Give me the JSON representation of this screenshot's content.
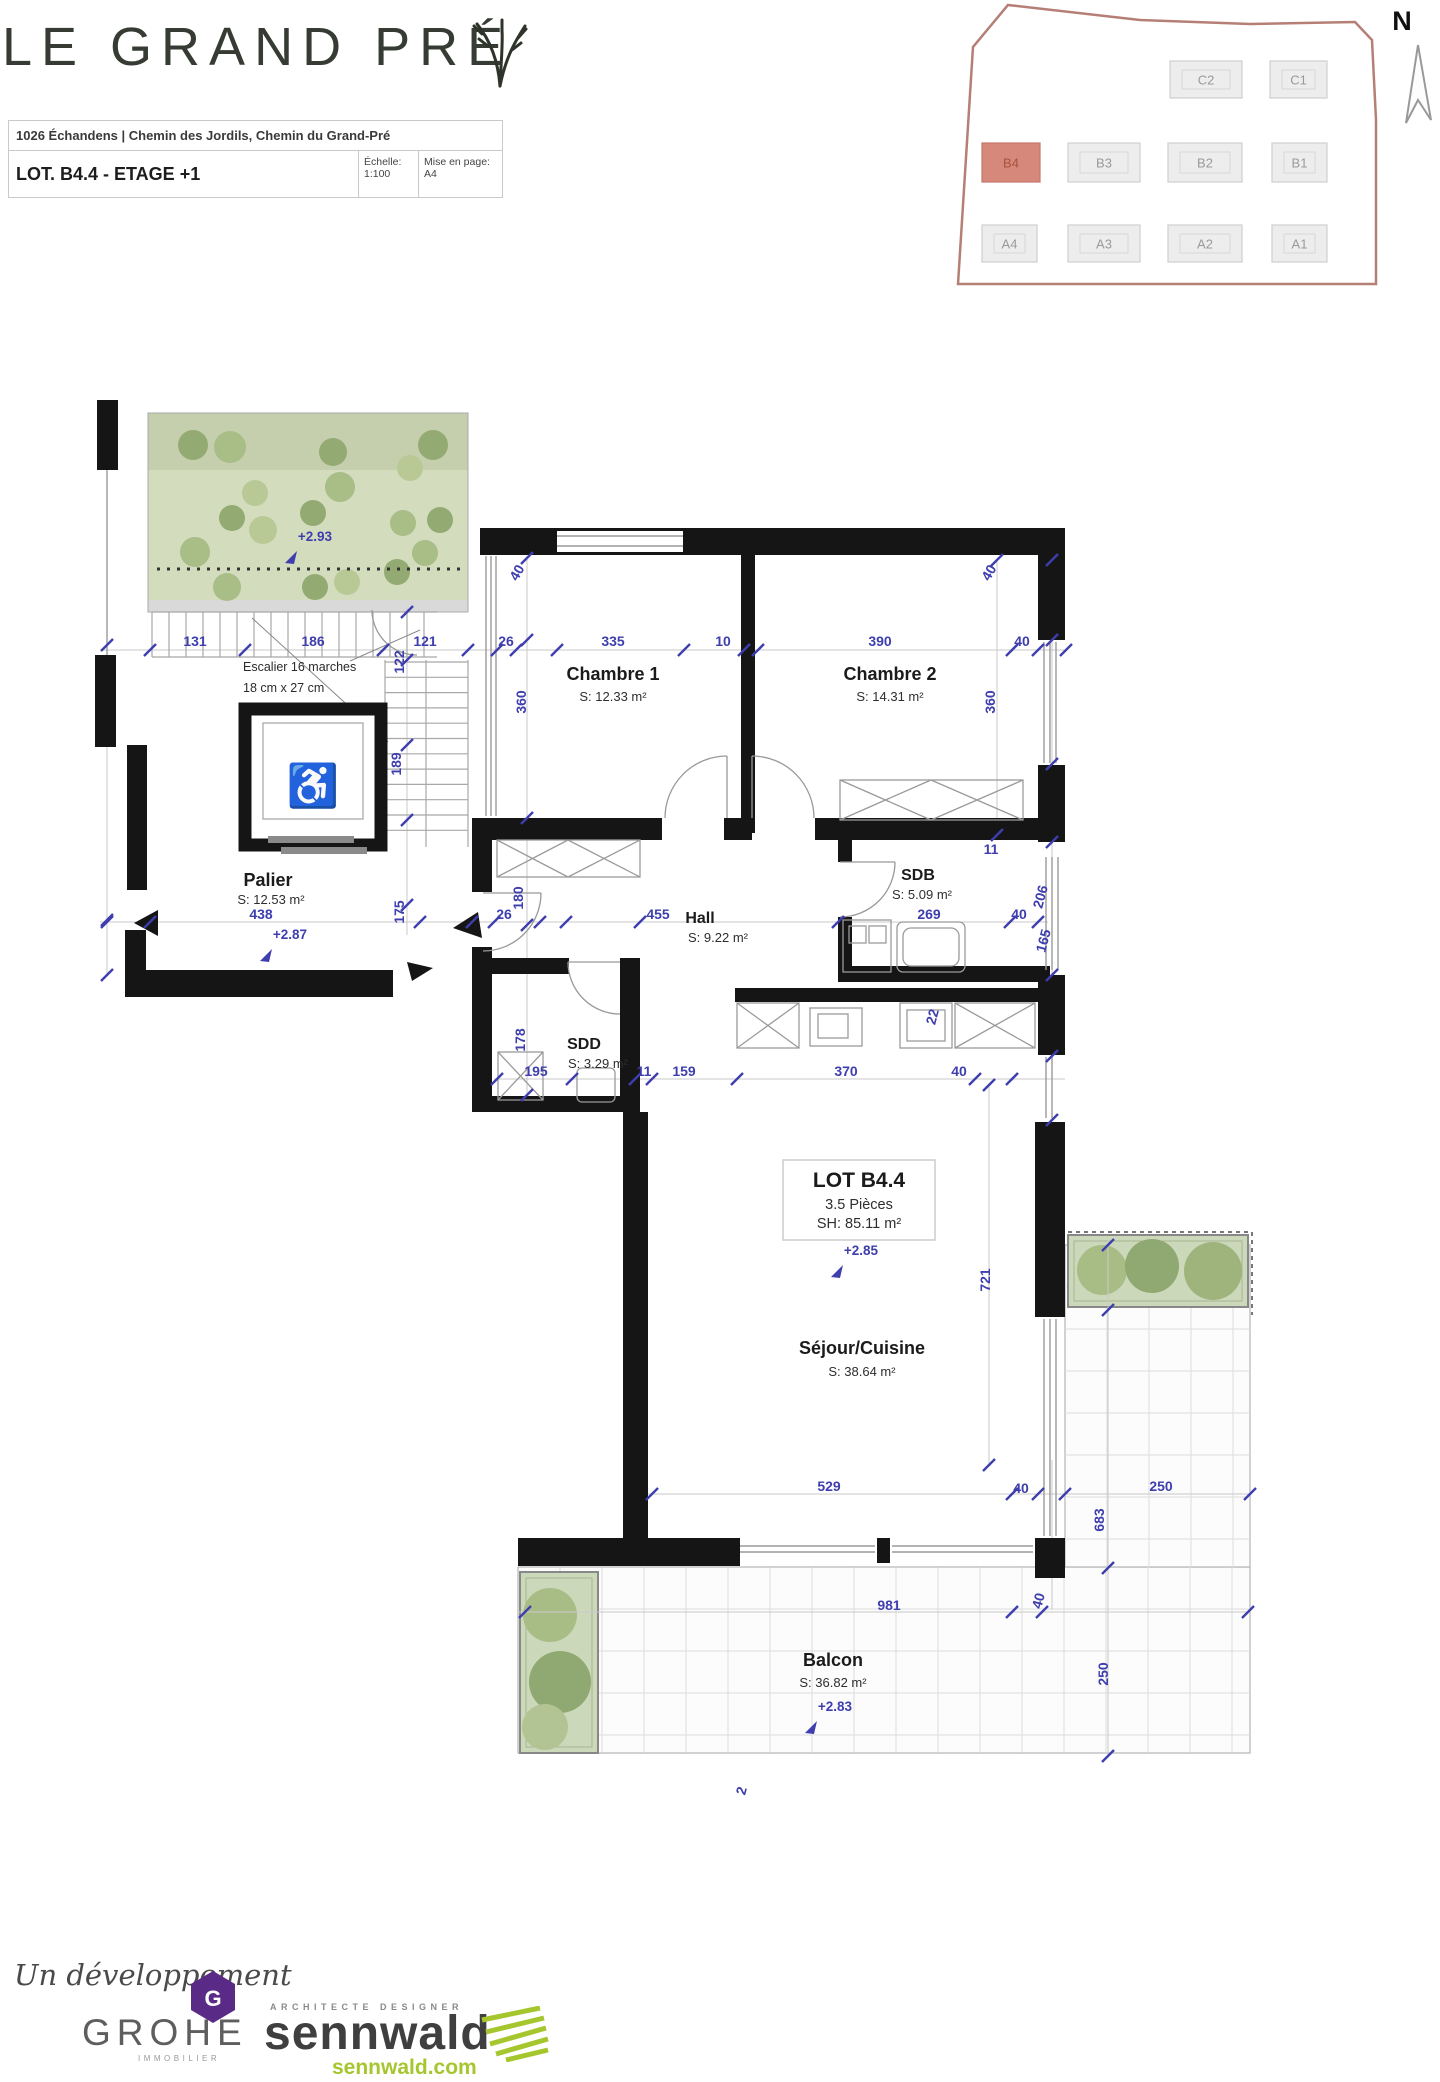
{
  "header": {
    "title": "LE GRAND PRÉ",
    "address": "1026 Échandens | Chemin des Jordils, Chemin du Grand-Pré",
    "lot_title": "LOT. B4.4 - ETAGE +1",
    "scale_label": "Échelle:",
    "scale_value": "1:100",
    "layout_label": "Mise en page:",
    "layout_value": "A4"
  },
  "site_map": {
    "north_label": "N",
    "lots": [
      {
        "id": "C2",
        "x": 1170,
        "y": 61,
        "w": 72,
        "h": 37,
        "hl": false
      },
      {
        "id": "C1",
        "x": 1270,
        "y": 61,
        "w": 57,
        "h": 37,
        "hl": false
      },
      {
        "id": "B4",
        "x": 982,
        "y": 143,
        "w": 58,
        "h": 39,
        "hl": true
      },
      {
        "id": "B3",
        "x": 1068,
        "y": 143,
        "w": 72,
        "h": 39,
        "hl": false
      },
      {
        "id": "B2",
        "x": 1168,
        "y": 143,
        "w": 74,
        "h": 39,
        "hl": false
      },
      {
        "id": "B1",
        "x": 1272,
        "y": 143,
        "w": 55,
        "h": 39,
        "hl": false
      },
      {
        "id": "A4",
        "x": 982,
        "y": 225,
        "w": 55,
        "h": 37,
        "hl": false
      },
      {
        "id": "A3",
        "x": 1068,
        "y": 225,
        "w": 72,
        "h": 37,
        "hl": false
      },
      {
        "id": "A2",
        "x": 1168,
        "y": 225,
        "w": 74,
        "h": 37,
        "hl": false
      },
      {
        "id": "A1",
        "x": 1272,
        "y": 225,
        "w": 55,
        "h": 37,
        "hl": false
      }
    ]
  },
  "plan": {
    "lot_box": {
      "line1": "LOT B4.4",
      "line2": "3.5 Pièces",
      "line3": "SH: 85.11 m²"
    },
    "stair_note_1": "Escalier 16 marches",
    "stair_note_2": "18 cm x 27 cm",
    "rooms": [
      {
        "name": "Chambre 1",
        "area": "S: 12.33 m²",
        "x": 613,
        "y": 680,
        "ax": 613,
        "ay": 701,
        "fs": 18
      },
      {
        "name": "Chambre 2",
        "area": "S: 14.31 m²",
        "x": 890,
        "y": 680,
        "ax": 890,
        "ay": 701,
        "fs": 18
      },
      {
        "name": "SDB",
        "area": "S: 5.09 m²",
        "x": 918,
        "y": 880,
        "ax": 922,
        "ay": 899,
        "fs": 16
      },
      {
        "name": "Hall",
        "area": "S: 9.22 m²",
        "x": 700,
        "y": 923,
        "ax": 718,
        "ay": 942,
        "fs": 16
      },
      {
        "name": "SDD",
        "area": "S: 3.29 m²",
        "x": 584,
        "y": 1049,
        "ax": 598,
        "ay": 1068,
        "fs": 16
      },
      {
        "name": "Palier",
        "area": "S: 12.53 m²",
        "x": 268,
        "y": 886,
        "ax": 271,
        "ay": 904,
        "fs": 18
      },
      {
        "name": "Séjour/Cuisine",
        "area": "S: 38.64 m²",
        "x": 862,
        "y": 1354,
        "ax": 862,
        "ay": 1376,
        "fs": 18
      },
      {
        "name": "Balcon",
        "area": "S: 36.82 m²",
        "x": 833,
        "y": 1666,
        "ax": 833,
        "ay": 1687,
        "fs": 18
      }
    ],
    "elevations": [
      {
        "t": "+2.93",
        "x": 315,
        "y": 541
      },
      {
        "t": "+2.87",
        "x": 290,
        "y": 939
      },
      {
        "t": "+2.85",
        "x": 861,
        "y": 1255
      },
      {
        "t": "+2.83",
        "x": 835,
        "y": 1711
      }
    ],
    "dimensions": [
      {
        "t": "131",
        "x": 195,
        "y": 646
      },
      {
        "t": "186",
        "x": 313,
        "y": 646
      },
      {
        "t": "121",
        "x": 425,
        "y": 646
      },
      {
        "t": "26",
        "x": 506,
        "y": 646
      },
      {
        "t": "335",
        "x": 613,
        "y": 646
      },
      {
        "t": "10",
        "x": 723,
        "y": 646
      },
      {
        "t": "390",
        "x": 880,
        "y": 646
      },
      {
        "t": "40",
        "x": 1022,
        "y": 646
      },
      {
        "t": "122",
        "x": 404,
        "y": 662,
        "r": -90
      },
      {
        "t": "360",
        "x": 526,
        "y": 702,
        "r": -90
      },
      {
        "t": "360",
        "x": 995,
        "y": 702,
        "r": -90
      },
      {
        "t": "189",
        "x": 401,
        "y": 764,
        "r": -90
      },
      {
        "t": "40",
        "x": 521,
        "y": 575,
        "r": -60
      },
      {
        "t": "40",
        "x": 993,
        "y": 575,
        "r": -60
      },
      {
        "t": "438",
        "x": 261,
        "y": 919
      },
      {
        "t": "26",
        "x": 504,
        "y": 919
      },
      {
        "t": "455",
        "x": 658,
        "y": 919
      },
      {
        "t": "269",
        "x": 929,
        "y": 919
      },
      {
        "t": "40",
        "x": 1019,
        "y": 919
      },
      {
        "t": "11",
        "x": 991,
        "y": 854
      },
      {
        "t": "175",
        "x": 404,
        "y": 912,
        "r": -90
      },
      {
        "t": "180",
        "x": 523,
        "y": 898,
        "r": -90
      },
      {
        "t": "206",
        "x": 1045,
        "y": 898,
        "r": -75
      },
      {
        "t": "165",
        "x": 1048,
        "y": 942,
        "r": -75
      },
      {
        "t": "195",
        "x": 536,
        "y": 1076
      },
      {
        "t": "11",
        "x": 644,
        "y": 1076
      },
      {
        "t": "159",
        "x": 684,
        "y": 1076
      },
      {
        "t": "370",
        "x": 846,
        "y": 1076
      },
      {
        "t": "40",
        "x": 959,
        "y": 1076
      },
      {
        "t": "178",
        "x": 525,
        "y": 1040,
        "r": -90
      },
      {
        "t": "22",
        "x": 937,
        "y": 1018,
        "r": -75
      },
      {
        "t": "721",
        "x": 990,
        "y": 1280,
        "r": -90
      },
      {
        "t": "529",
        "x": 829,
        "y": 1491
      },
      {
        "t": "40",
        "x": 1021,
        "y": 1493
      },
      {
        "t": "250",
        "x": 1161,
        "y": 1491
      },
      {
        "t": "683",
        "x": 1104,
        "y": 1520,
        "r": -90
      },
      {
        "t": "981",
        "x": 889,
        "y": 1610
      },
      {
        "t": "40",
        "x": 1043,
        "y": 1602,
        "r": -75
      },
      {
        "t": "250",
        "x": 1108,
        "y": 1674,
        "r": -90
      },
      {
        "t": "2",
        "x": 746,
        "y": 1792,
        "r": -75
      }
    ]
  },
  "footer": {
    "dev_script": "Un développement",
    "grohe": "GROHE",
    "grohe_sub": "IMMOBILIER",
    "grohe_badge_letter": "G",
    "architect_tag": "ARCHITECTE DESIGNER",
    "architect_name": "sennwald",
    "architect_site": "sennwald.com"
  },
  "colors": {
    "dimension_blue": "#3e3eae",
    "wall_black": "#151515",
    "lot_highlight": "#d6897a",
    "garden_green": "#d3dcbd",
    "logo_purple": "#5a2b86",
    "logo_green": "#a6c62e",
    "site_outline": "#b57f76"
  }
}
